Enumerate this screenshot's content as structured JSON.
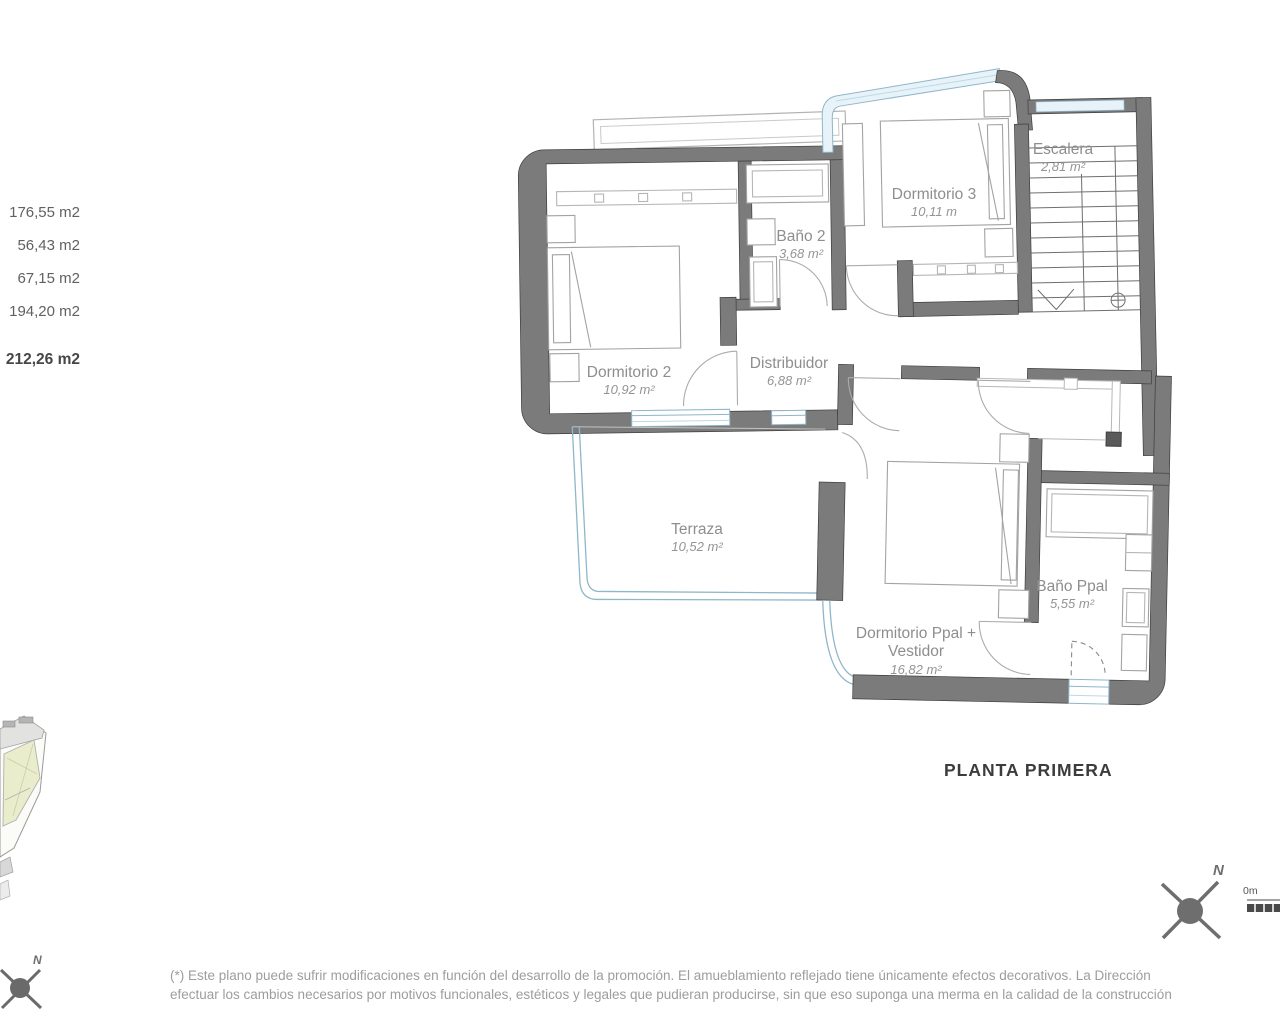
{
  "summary": {
    "areas": [
      "176,55 m2",
      "56,43 m2",
      "67,15 m2",
      "194,20 m2"
    ],
    "total": "212,26 m2"
  },
  "plan": {
    "title": "PLANTA PRIMERA",
    "rooms": {
      "dormitorio3": {
        "name": "Dormitorio 3",
        "area": "10,11 m"
      },
      "escalera": {
        "name": "Escalera",
        "area": "2,81 m²"
      },
      "bano2": {
        "name": "Baño 2",
        "area": "3,68 m²"
      },
      "dormitorio2": {
        "name": "Dormitorio 2",
        "area": "10,92 m²"
      },
      "distribuidor": {
        "name": "Distribuidor",
        "area": "6,88 m²"
      },
      "terraza": {
        "name": "Terraza",
        "area": "10,52 m²"
      },
      "bano_ppal": {
        "name": "Baño Ppal",
        "area": "5,55 m²"
      },
      "dormitorio_ppal": {
        "name_line1": "Dormitorio Ppal +",
        "name_line2": "Vestidor",
        "area": "16,82 m²"
      }
    }
  },
  "compass": {
    "north": "N"
  },
  "scale_bar": {
    "zero": "0m"
  },
  "footer": {
    "lines": [
      "(*) Este plano puede sufrir modificaciones en función del desarrollo de la promoción. El amueblamiento reflejado tiene únicamente efectos decorativos. La Dirección",
      "efectuar los cambios necesarios por motivos funcionales, estéticos y legales que pudieran producirse, sin que eso suponga una merma en la calidad de la construcción"
    ]
  },
  "colors": {
    "wall": "#7b7b7b",
    "glass_line": "#8fb6c9",
    "glass_fill": "#e8f3f9",
    "label": "#8e8e8e",
    "parcel": "#e9edcc"
  }
}
